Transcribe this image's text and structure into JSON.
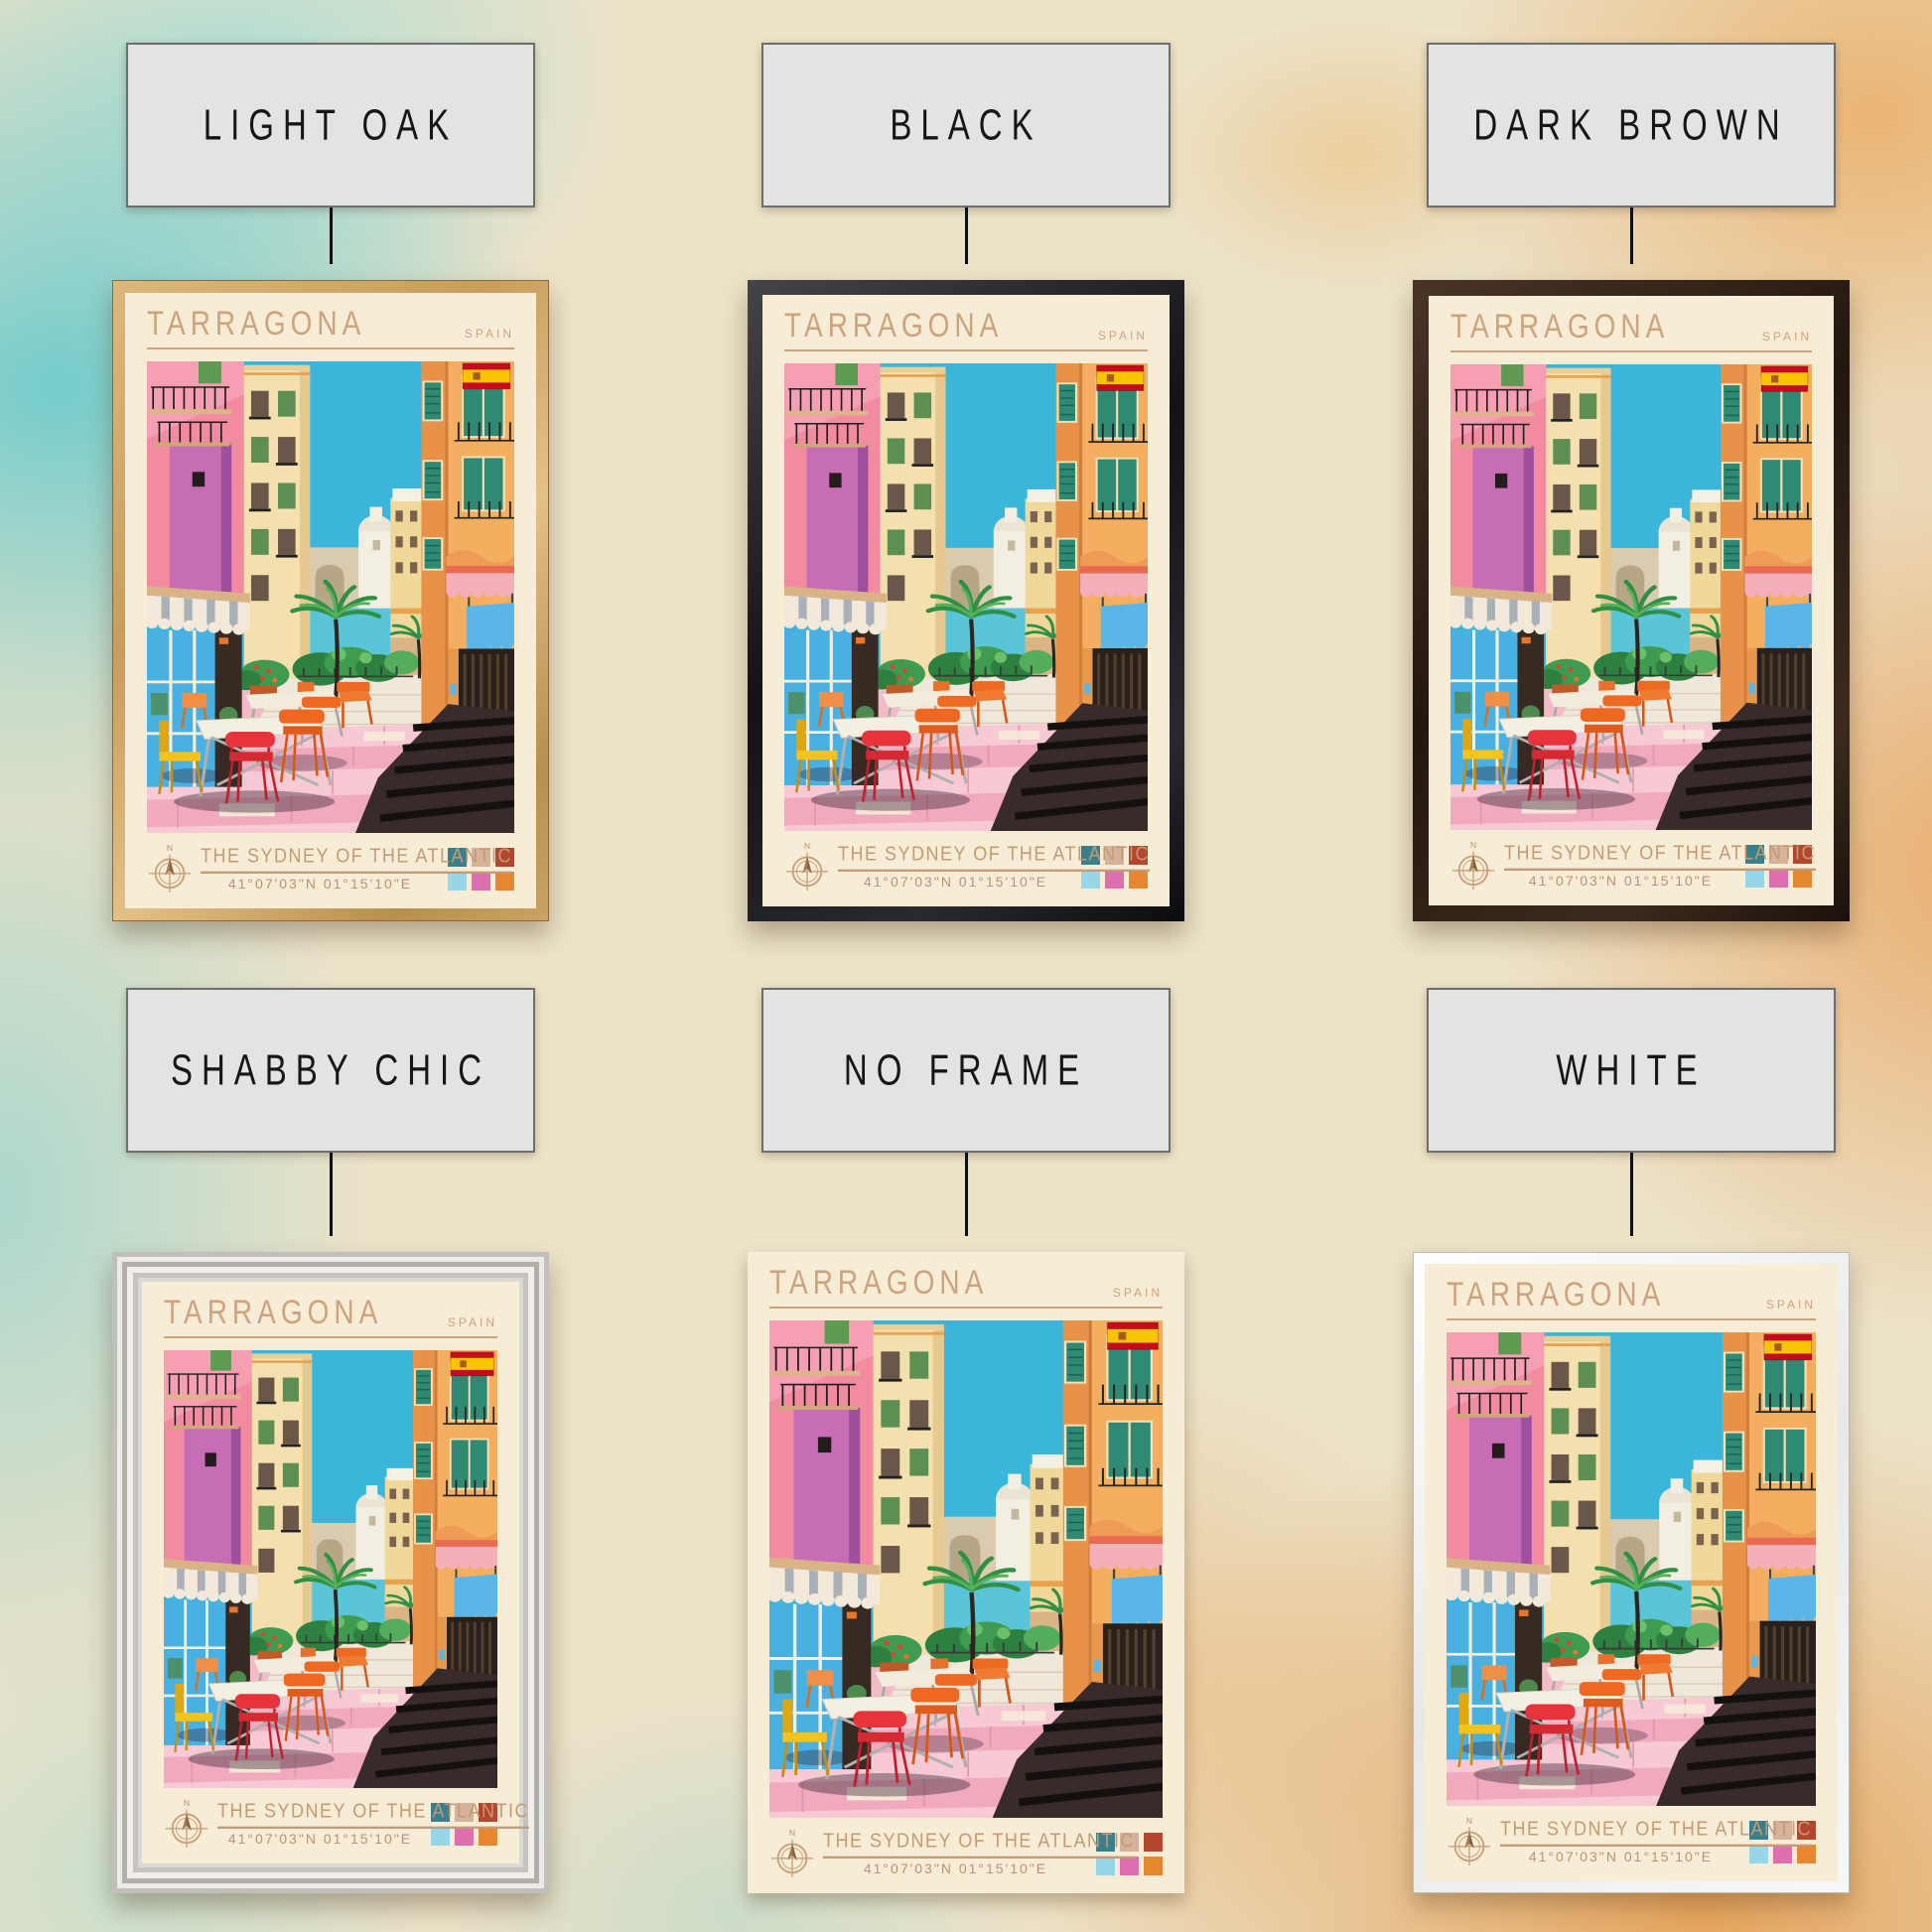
{
  "frames": [
    {
      "id": "light-oak",
      "label": "LIGHT OAK",
      "color": "#c9a05f"
    },
    {
      "id": "black",
      "label": "BLACK",
      "color": "#1a1a1c"
    },
    {
      "id": "dark-brown",
      "label": "DARK BROWN",
      "color": "#2e2016"
    },
    {
      "id": "shabby-chic",
      "label": "SHABBY CHIC",
      "color": "#dbd9d4"
    },
    {
      "id": "no-frame",
      "label": "NO FRAME",
      "color": "none"
    },
    {
      "id": "white",
      "label": "WHITE",
      "color": "#f4f4f2"
    }
  ],
  "poster": {
    "title": "TARRAGONA",
    "country": "SPAIN",
    "subtitle": "THE SYDNEY OF THE ATLANTIC",
    "coordinates": "41°07'03\"N 01°15'10\"E",
    "compass_label": "N",
    "paper_color": "#f7ecd6",
    "ink_color": "#cda37e",
    "flag_icon": {
      "name": "spain-flag-icon",
      "red": "#c60b1e",
      "yellow": "#f7c400"
    },
    "palette_swatches": [
      "#3a7f8c",
      "#d4b29c",
      "#b5462e",
      "#97d5e8",
      "#dd6fae",
      "#e6862f"
    ]
  }
}
